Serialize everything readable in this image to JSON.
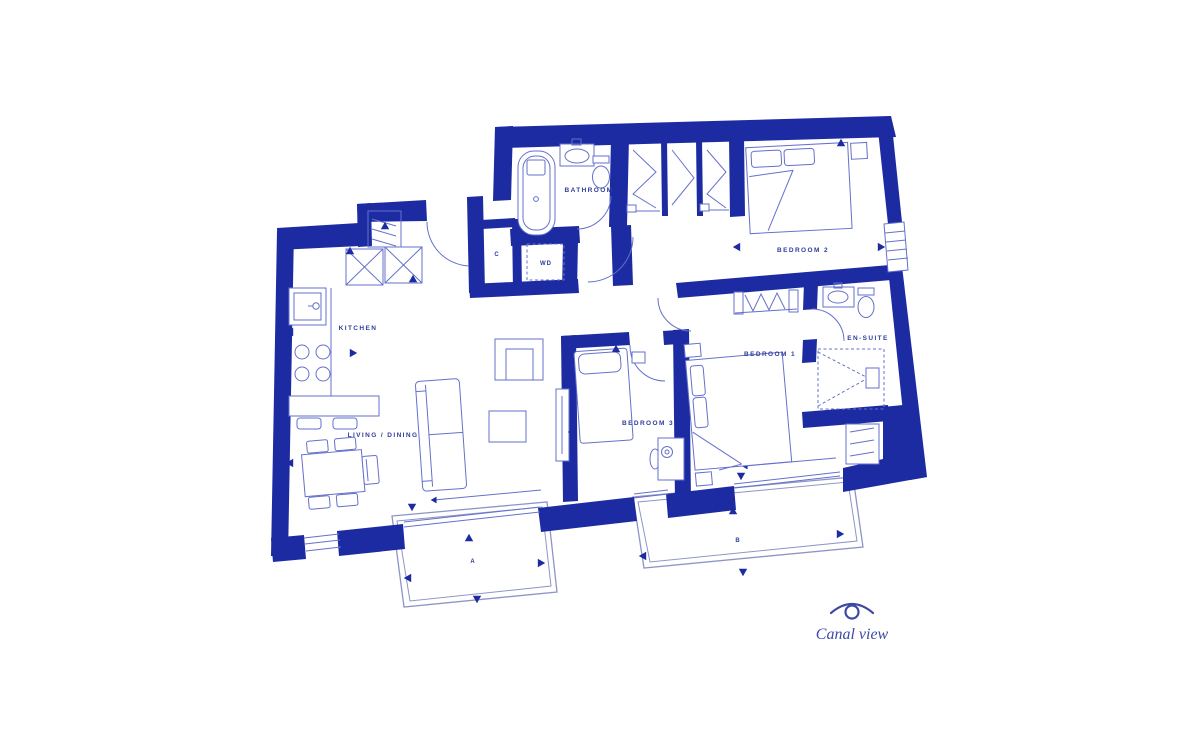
{
  "colors": {
    "wall": "#1d2ba2",
    "line": "#6470cc",
    "railing": "#8d95c7",
    "label": "#2f3c9c",
    "bg": "#ffffff"
  },
  "rooms": {
    "kitchen": "KITCHEN",
    "living_dining": "LIVING / DINING",
    "bathroom": "BATHROOM",
    "bedroom1": "BEDROOM 1",
    "bedroom2": "BEDROOM 2",
    "bedroom3": "BEDROOM 3",
    "ensuite": "EN-SUITE"
  },
  "storage": {
    "closet": "C",
    "washer_dryer": "WD"
  },
  "balconies": {
    "a": "A",
    "b": "B"
  },
  "view": {
    "label": "Canal view",
    "icon": "eye-icon"
  }
}
